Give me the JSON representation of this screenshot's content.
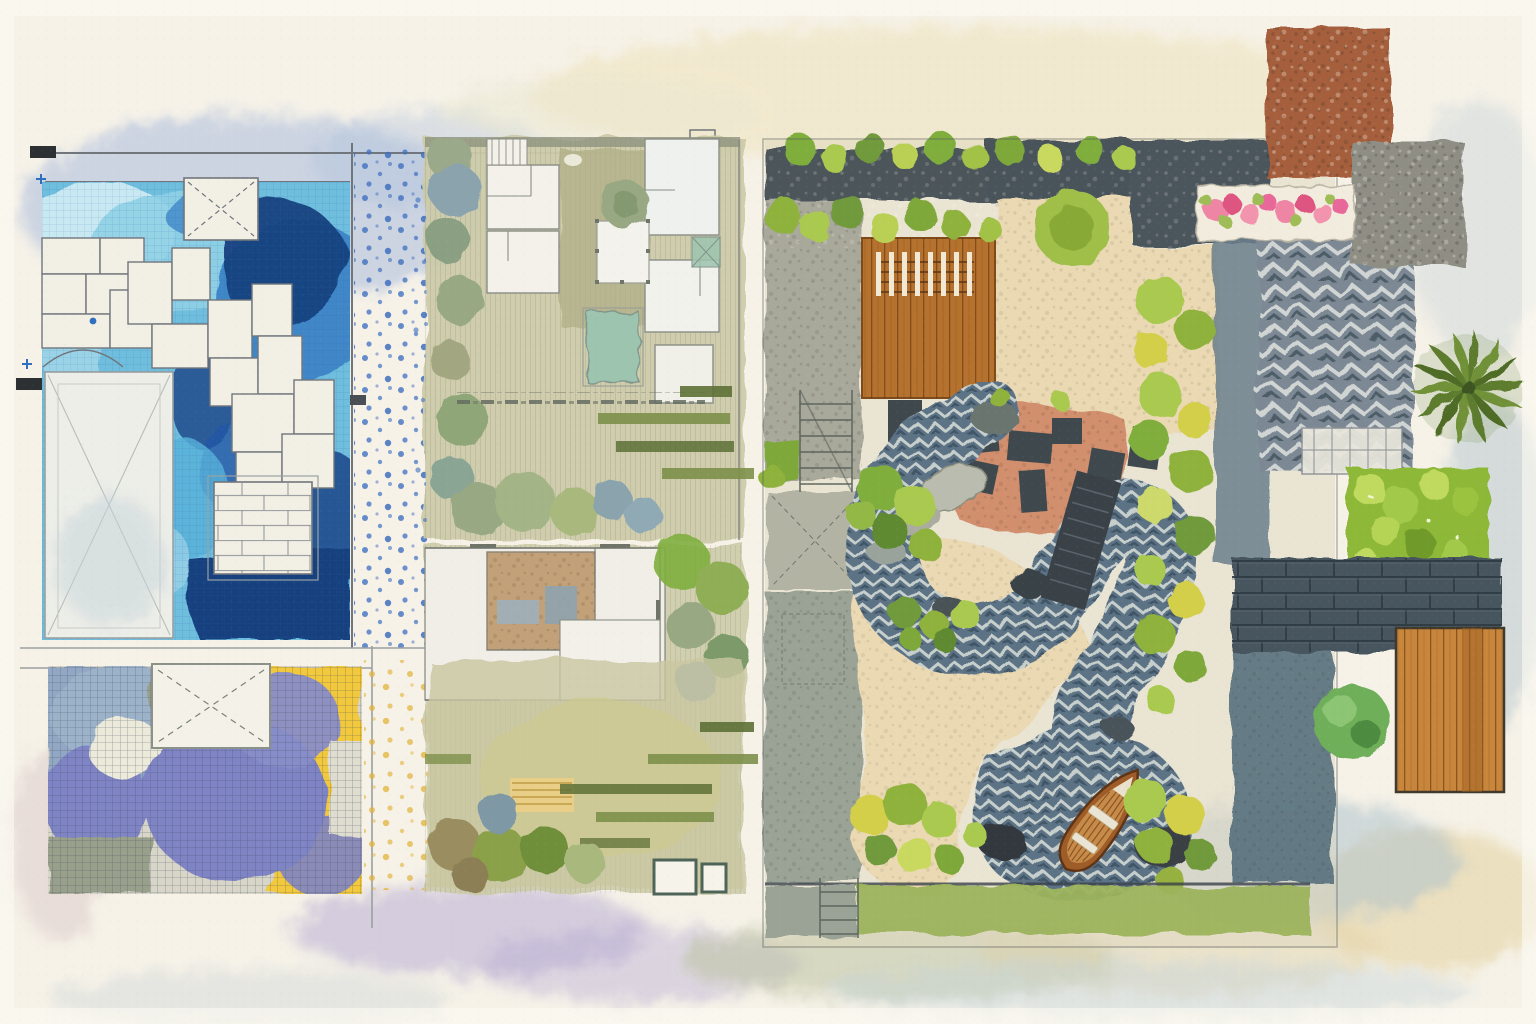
{
  "artwork": {
    "kind": "watercolor-architecture-landscape-plan-collage",
    "visible_text": "none",
    "orientation": "landscape"
  },
  "palette": {
    "paper": "#f6f2e8",
    "paperEdge": "#fbf9f1",
    "inkWall": "#70767c",
    "poolPale": "#c9e9f2",
    "poolLight": "#8fd0e6",
    "poolSky": "#6fbede",
    "poolMid": "#3f87c8",
    "poolDeep": "#2458a6",
    "poolNavy": "#17407e",
    "paver": "#f2efe5",
    "dotBlue": "#3f6fc0",
    "dotYellow": "#e2b338",
    "tileBlueGray": "#92a7c3",
    "tilePurple": "#7f84c4",
    "tileSage": "#98a08b",
    "tileYellow": "#f2c83c",
    "planSage": "#cdcbaa",
    "planOlive": "#b0ae85",
    "roomWhite": "#f3f1e9",
    "poolTeal": "#9dc4af",
    "barOlive": "#7d904a",
    "barDark": "#5d7036",
    "charcoal": "#4b545a",
    "deckWood": "#b5712e",
    "deckWood2": "#c8863c",
    "gravelCream": "#ead9b2",
    "gravelPink": "#d28f6e",
    "pathBase": "#5c7285",
    "rockDark": "#394246",
    "boatHull": "#9e5c28",
    "boatPlank": "#c78b49",
    "boatSeat": "#eae4d4",
    "terracotta": "#a65f3e",
    "stoneGray": "#8f8e85",
    "flowerPink": "#ef85a5",
    "flowerDeep": "#dd5480",
    "flowerLeaf": "#9fbd56",
    "hedgeGreen": "#8db837",
    "hedgeLight": "#c0da60",
    "brickBand": "#46545e",
    "grass": "#9cb45c",
    "shrubGreen": "#7fae3e",
    "shrubLight": "#a9c94f",
    "shrubYellow": "#d3cf49",
    "shrubDark": "#5e8a33",
    "treeGreen": "#97a883",
    "treeBlue": "#8aa3ad",
    "washBlue": "#a9bcdc",
    "washLavender": "#b3a8d1",
    "washSand": "#e5d3a4",
    "washSage": "#bcc3a0",
    "washBlueGray": "#aabfca"
  },
  "panels": [
    {
      "id": "pool-terrace-blueprint",
      "position": "top-left",
      "features": [
        "swimming-pool-water",
        "stone-paver-chain",
        "x-marked-skimmer-box",
        "garage-pad",
        "brick-spa-box",
        "door-swing-arc",
        "blue-dot-stipple-strip",
        "wall-lines",
        "black-door-ticks",
        "plus-survey-marks"
      ]
    },
    {
      "id": "tile-mosaic-plan",
      "position": "bottom-left",
      "features": [
        "blue-gray-tile-field",
        "purple-tile-field",
        "sage-tile-field",
        "yellow-tile-field",
        "fine-crosshatch-grid",
        "x-marked-box",
        "yellow-dot-stipple-strip",
        "lavender-washes"
      ]
    },
    {
      "id": "site-plan-upper",
      "position": "center-top",
      "features": [
        "white-rooms",
        "stair-hatch",
        "lawn",
        "round-tree",
        "post-pergola-square",
        "x-marked-square",
        "plunge-pool",
        "hedge-column",
        "gravel-dash-band",
        "olive-plank-bars",
        "tree-row",
        "blue-dot-accents"
      ]
    },
    {
      "id": "site-plan-lower",
      "position": "center-bottom",
      "features": [
        "white-rooms",
        "tan-room-with-furniture",
        "lawn",
        "hedge-column",
        "olive-plank-bars",
        "yellow-striped-patch",
        "bush-row",
        "outline-squares"
      ]
    },
    {
      "id": "courtyard-garden-plan",
      "position": "right",
      "features": [
        "charcoal-gravel-band",
        "shrub-hedgerows",
        "concrete-pads-with-stair-sketches",
        "timber-deck-with-pergola-slats",
        "cream-gravel-field",
        "salmon-gravel-patch",
        "charcoal-slabs",
        "herringbone-stone-stream",
        "boulders",
        "dark-plank-bridge",
        "wooden-rowboat",
        "yellow-green-shrub-border",
        "grass-strip",
        "round-canopy-tree"
      ]
    },
    {
      "id": "material-swatches-margin",
      "position": "far-right",
      "features": [
        "terracotta-aggregate-swatch",
        "granite-aggregate-swatch",
        "pink-flower-planter",
        "herringbone-paver-swatch",
        "palm-tree-top",
        "clipped-hedge-swatch",
        "dark-brick-band",
        "timber-deck-swatch",
        "round-shrub",
        "pergola-pencil-sketch"
      ]
    }
  ]
}
